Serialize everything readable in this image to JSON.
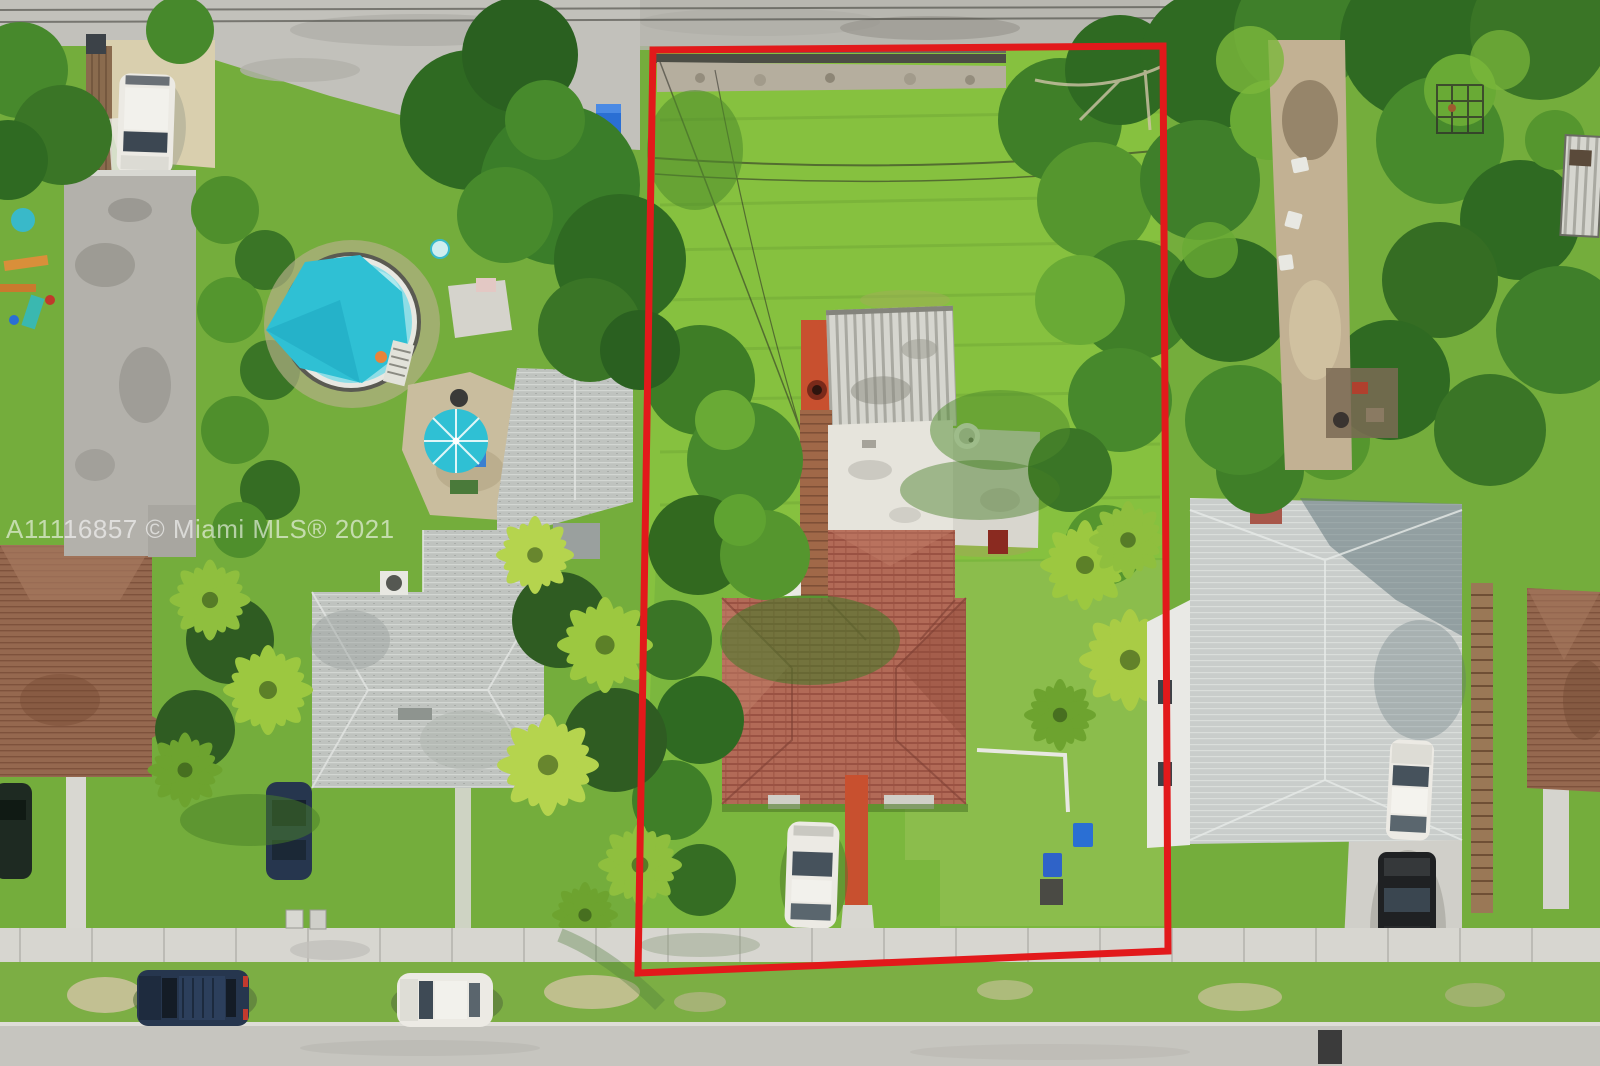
{
  "photo": {
    "watermark": "A11116857 © Miami MLS® 2021"
  },
  "colors": {
    "boundary_red": "#e2191b",
    "watermark_white": "rgba(255,255,255,0.58)",
    "grass_base": "#74ad3c",
    "grass_bright": "#86c13f",
    "grass_front": "#7bb73e",
    "grass_parkway": "#7cae44",
    "tree_dark": "#2f6a22",
    "tree_mid": "#47892c",
    "tree_light": "#69aa35",
    "palm_bright": "#a9cc45",
    "pool_teal": "#2fc0d4",
    "pool_water": "#8edde6",
    "pavement": "#c2c1bb",
    "sidewalk": "#d7d6d0",
    "street": "#c6c5bf",
    "sand": "#d9cfae",
    "roof_tile": "#b26a57",
    "roof_shingle_left": "#bfc3bf",
    "roof_shingle_right": "#c9cdcb",
    "roof_brown": "#95684f",
    "roof_flat_white": "#e6e4dc",
    "shed_metal": "#d6d6cf",
    "deck_red": "#c8502f",
    "deck_wood": "#a06848",
    "car_white": "#eceae4",
    "car_dark_blue": "#26364e",
    "truck_black": "#1f2123",
    "bin_blue": "#2a6fd4",
    "building_gray": "#b3b1ab"
  }
}
